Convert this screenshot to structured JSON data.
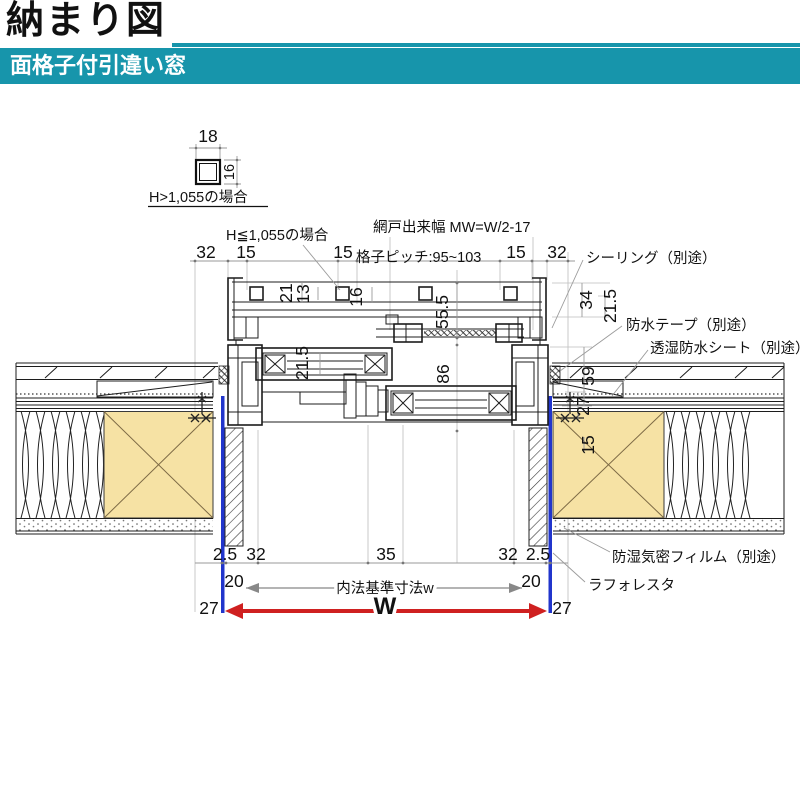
{
  "header": {
    "title": "納まり図",
    "subtitle": "面格子付引違い窓",
    "accent": "#1795ab"
  },
  "inset": {
    "w": "18",
    "h": "16",
    "caption": "H>1,055の場合"
  },
  "notes": {
    "grille_case": "H≦1,055の場合",
    "screen_width": "網戸出来幅 MW=W/2-17",
    "grille_pitch": "格子ピッチ:95~103"
  },
  "callouts": {
    "sealing": "シーリング（別途）",
    "tape": "防水テープ（別途）",
    "sheet": "透湿防水シート（別途）",
    "film": "防湿気密フィルム（別途）",
    "laforesta": "ラフォレスタ"
  },
  "dims": {
    "top_32_l": "32",
    "top_15_l": "15",
    "top_15_m": "15",
    "top_15_r": "15",
    "top_32_r": "32",
    "g21": "21",
    "g13": "13",
    "g16": "16",
    "g555": "55.5",
    "s215": "21.5",
    "s86": "86",
    "r34": "34",
    "r215": "21.5",
    "r59": "59",
    "r27": "27",
    "r15": "15",
    "b25_l": "2.5",
    "b32_l": "32",
    "b35": "35",
    "b32_r": "32",
    "b25_r": "2.5",
    "b20_l": "20",
    "b20_r": "20",
    "inner_w": "内法基準寸法w",
    "b27_l": "27",
    "b27_r": "27",
    "w": "W"
  },
  "colors": {
    "accent": "#1795ab",
    "wood": "#f6e2a4",
    "casing_blue": "#2135cc",
    "w_red": "#cf2020"
  }
}
